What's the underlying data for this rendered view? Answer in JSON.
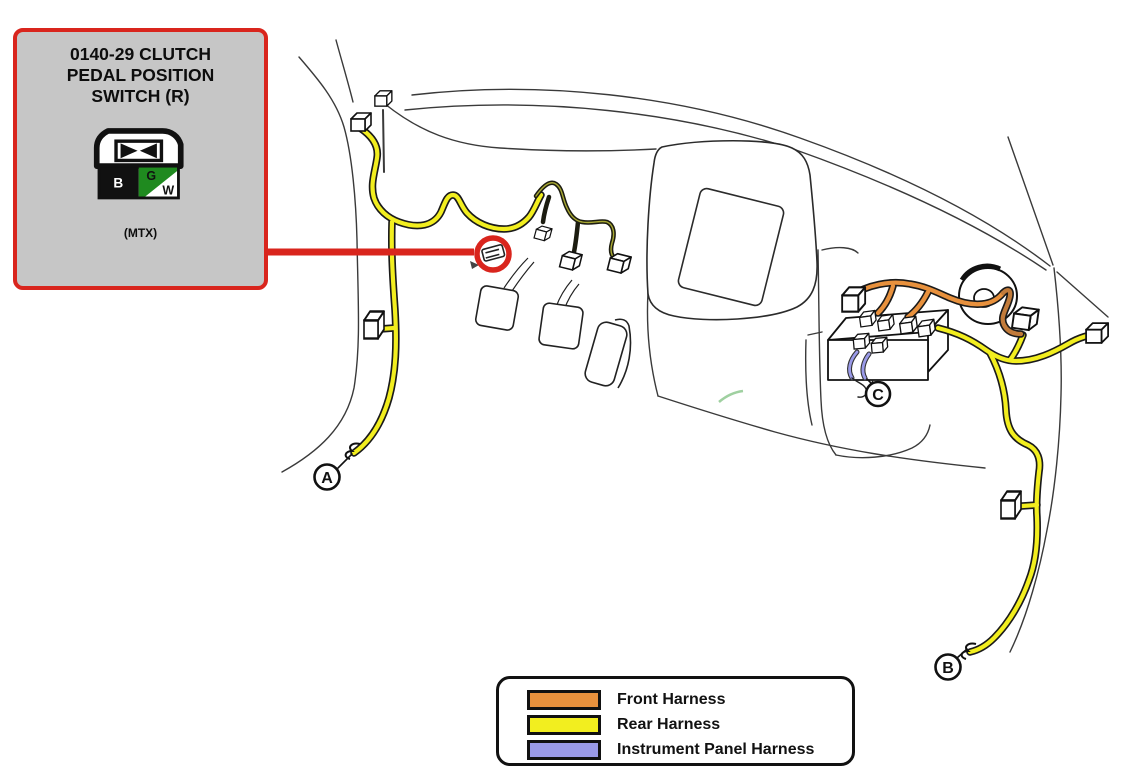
{
  "diagram": {
    "title_block": {
      "title_lines": [
        "0140-29 CLUTCH",
        "PEDAL POSITION",
        "SWITCH (R)"
      ],
      "variant_note": "(MTX)",
      "connector_pins": {
        "left": "B",
        "top": "G",
        "bottom_right": "W"
      }
    },
    "location_labels": {
      "a": "A",
      "b": "B",
      "c": "C"
    },
    "legend": {
      "items": [
        {
          "label": "Front Harness",
          "color": "#E8913D"
        },
        {
          "label": "Rear Harness",
          "color": "#F2EE1F"
        },
        {
          "label": "Instrument Panel Harness",
          "color": "#9A9AE8"
        }
      ]
    },
    "colors": {
      "highlight_red": "#D9251D",
      "callout_background": "#C6C6C6",
      "connector_green": "#1F8A1F",
      "pedal_harness_core": "#A8A832",
      "line_art": "#2B2B2B"
    }
  }
}
